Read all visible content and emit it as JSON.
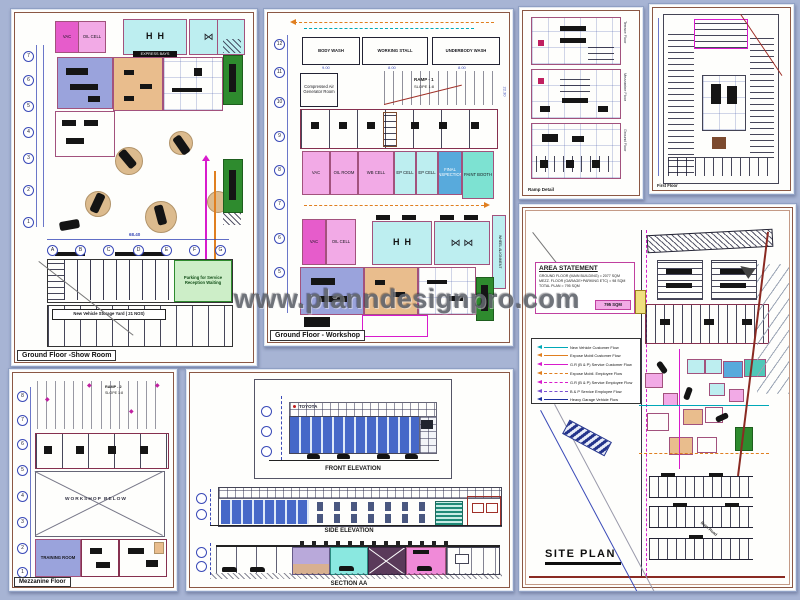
{
  "watermark": "www.planndesignpro.com",
  "colors": {
    "background": "#a7b4d4",
    "panel": "#fefefc",
    "frame": "#8b5744",
    "magenta_room": "#e65ccb",
    "pink_room": "#f2aae6",
    "cyan_room": "#bdeef0",
    "teal_room": "#7de2d2",
    "blue_room": "#58aadc",
    "purple_room": "#9aa3dc",
    "tan_room": "#e9bd8d",
    "green_area": "#2e8b2e",
    "light_green": "#cdeec8",
    "dim_blue": "#3a4ab8",
    "wall_maroon": "#8b5744",
    "flow_cyan": "#00a8b8",
    "flow_orange": "#e07f20",
    "flow_magenta": "#d81bcc",
    "flow_navy": "#1c2f9e"
  },
  "panels": {
    "showroom": {
      "title": "Ground Floor -Show Room",
      "rooms": {
        "vac": "VAC",
        "oil": "OIL CELL",
        "bays": "EXPRESS BAYS"
      },
      "parking_note": "Parking for Service Reception Waiting",
      "yard_note": "New Vehicle Storage Yard ( 21 NOS)",
      "dim_total": "68.40",
      "grid_letters": [
        "A",
        "B",
        "C",
        "D",
        "E",
        "F",
        "G"
      ],
      "grid_numbers": [
        "7",
        "6",
        "5",
        "4",
        "3",
        "2",
        "1"
      ]
    },
    "workshop": {
      "title": "Ground Floor - Workshop",
      "wash_rooms": [
        "BODY WASH",
        "WORKING STALL",
        "UNDERBODY WASH"
      ],
      "wash_dims": [
        "9.00",
        "8.00",
        "8.00"
      ],
      "ramp_label": "RAMP - 1",
      "slope_label": "SLOPE 1:8",
      "generator_room": "Compressed Air Generator Room",
      "cells": [
        "VAC",
        "OIL ROOM",
        "WB CELL",
        "EP CELL",
        "EP CELL",
        "FINAL INSPECTION",
        "PAINT BOOTH"
      ],
      "bay_rooms": [
        "VAC",
        "OIL CELL"
      ],
      "wheel_alignment": "WHEEL ALIGNMENT",
      "dim_side": "22.30",
      "grid_numbers": [
        "12",
        "11",
        "10",
        "9",
        "8",
        "7",
        "6",
        "5"
      ]
    },
    "ramp_detail": {
      "title": "Ramp Detail",
      "floor_labels": [
        "Terrace Floor",
        "Mezzanine Floor",
        "Ground Floor"
      ]
    },
    "first_floor": {
      "title": "First Floor"
    },
    "site_plan": {
      "title": "SITE PLAN",
      "area_statement": {
        "title": "AREA STATEMENT",
        "lines": [
          "GROUND FLOOR (MAIN BUILDING) = 2077 SQM",
          "MEZZ. FLOOR (GARAGE+PARKING ETC) = 98 SQM",
          "TOTAL PLAN = 795 SQM"
        ],
        "highlight": "795 SQM"
      },
      "legend": [
        {
          "label": "New Vehicle Customer Flow",
          "color": "#00a8b8",
          "dash": "solid"
        },
        {
          "label": "Expose Mobil Customer Flow",
          "color": "#e07f20",
          "dash": "solid"
        },
        {
          "label": "G.R (B & P) Service Customer Flow",
          "color": "#d81bcc",
          "dash": "solid"
        },
        {
          "label": "Expose Mobil. Employee Flow",
          "color": "#e07f20",
          "dash": "dashed"
        },
        {
          "label": "G.R (B & P) Service Employee Flow",
          "color": "#d81bcc",
          "dash": "dashed"
        },
        {
          "label": "B & P Service Employee Flow",
          "color": "#7a4fd0",
          "dash": "dashed"
        },
        {
          "label": "Heavy Garage Vehicle Flow",
          "color": "#1c2f9e",
          "dash": "solid"
        }
      ],
      "road_label": "Main Road"
    },
    "mezzanine": {
      "title": "Mezzanine Floor",
      "ramp_label": "RAMP - 2",
      "slope_label": "SLOPE 1:8",
      "void_label": "WORKSHOP BELOW",
      "training_room": "TRAINING ROOM",
      "grid_numbers": [
        "8",
        "7",
        "6",
        "5",
        "4",
        "3",
        "2",
        "1"
      ]
    },
    "elevations": {
      "front_title": "FRONT ELEVATION",
      "side_title": "SIDE ELEVATION",
      "section_title": "SECTION AA",
      "brand": "TOYOTA"
    }
  }
}
